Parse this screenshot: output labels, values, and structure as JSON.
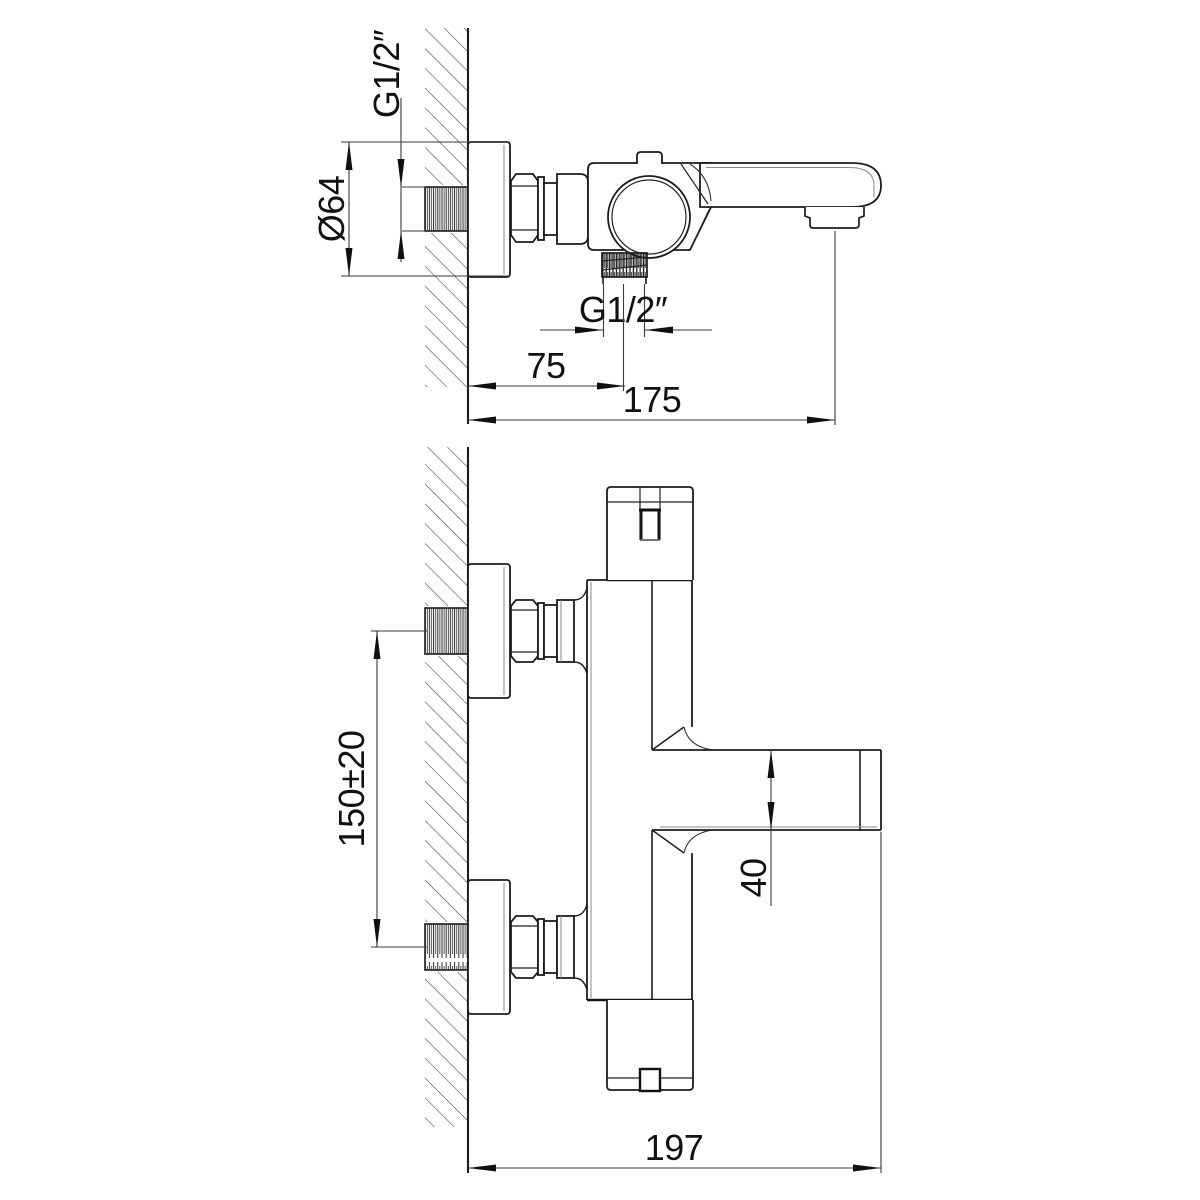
{
  "drawing": {
    "background": "#ffffff",
    "line_color": "#1c1c1c",
    "side_view": {
      "inlet_thread": "G1/2″",
      "flange_diameter": "Ø64",
      "outlet_thread": "G1/2″",
      "wall_to_outlet": "75",
      "wall_to_spout": "175"
    },
    "front_view": {
      "inlet_spacing": "150±20",
      "spout_height": "40",
      "total_depth": "197"
    }
  }
}
